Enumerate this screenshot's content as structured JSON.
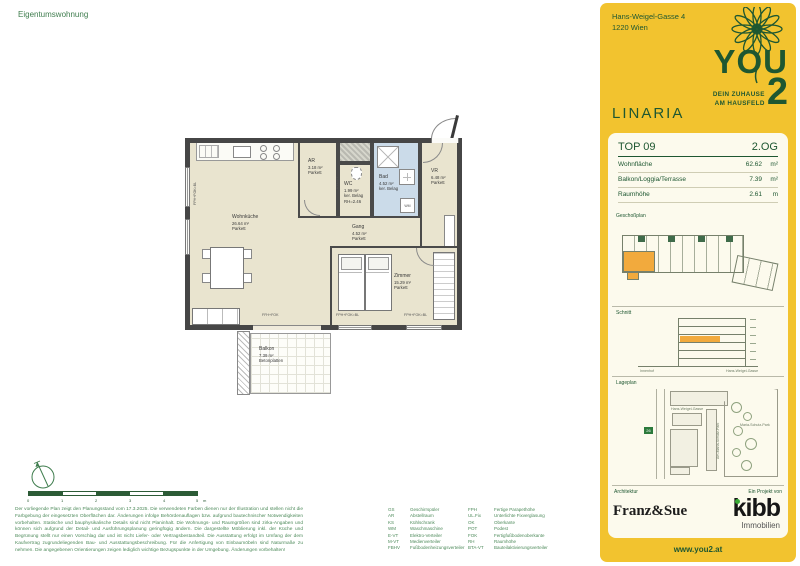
{
  "page": {
    "label": "Eigentumswohnung"
  },
  "colors": {
    "brand_yellow": "#F2C32F",
    "brand_green": "#1E5731",
    "highlight_orange": "#F2AA3D"
  },
  "sidebar": {
    "address": [
      "Hans-Weigel-Gasse 4",
      "1220 Wien"
    ],
    "logo": {
      "you": "YOU",
      "two": "2",
      "tagline1": "DEIN ZUHAUSE",
      "tagline2": "AM HAUSFELD"
    },
    "project": "LINARIA",
    "unit": {
      "top": "TOP 09",
      "floor": "2.OG"
    },
    "metrics": [
      {
        "label": "Wohnfläche",
        "value": "62.62",
        "unit": "m²"
      },
      {
        "label": "Balkon/Loggia/Terrasse",
        "value": "7.39",
        "unit": "m²"
      },
      {
        "label": "Raumhöhe",
        "value": "2.61",
        "unit": "m"
      }
    ],
    "sections": {
      "plan": "Geschoßplan",
      "section": "Schnitt",
      "site": "Lageplan",
      "architect": "Architektur",
      "project_by": "Ein Projekt von"
    },
    "schnitt": {
      "left_label": "Innenhof",
      "right_label": "Hans-Weigel-Gasse"
    },
    "site": {
      "street": "Hans-Weigel-Gasse",
      "street2": "Am-Maria-Schutz-Park",
      "park": "Maria-Schutz-Park",
      "transit": "26"
    },
    "brands": {
      "architect": "Franz&Sue",
      "developer": "kibb",
      "developer_sub": "Immobilien"
    },
    "website": "www.you2.at"
  },
  "plan": {
    "rooms": {
      "wohnkueche": {
        "name": "Wohnküche",
        "area": "26.64 m²",
        "floor": "Parkett"
      },
      "ar": {
        "name": "AR",
        "area": "3.18 m²",
        "floor": "Parkett"
      },
      "wc": {
        "name": "WC",
        "area": "1.99 m²",
        "floor": "ker. Belag",
        "note": "RH=2.46"
      },
      "bad": {
        "name": "Bad",
        "area": "4.52 m²",
        "floor": "ker. Belag"
      },
      "vr": {
        "name": "VR",
        "area": "6.48 m²",
        "floor": "Parkett"
      },
      "gang": {
        "name": "Gang",
        "area": "4.52 m²",
        "floor": "Parkett"
      },
      "zimmer": {
        "name": "Zimmer",
        "area": "15.29 m²",
        "floor": "Parkett"
      },
      "balkon": {
        "name": "Balkon",
        "area": "7.39 m²",
        "floor": "Betonplatten"
      }
    },
    "annotations": {
      "window": "FPH+FOK=BL",
      "door": "FFH+FOK",
      "shaft": "BTA/VT",
      "wm": "WM"
    },
    "scale": {
      "ticks": [
        "0",
        "1",
        "2",
        "3",
        "4",
        "5"
      ],
      "unit": "m"
    }
  },
  "legend": {
    "left": [
      {
        "abbr": "GS",
        "term": "Geschirrspüler"
      },
      {
        "abbr": "AR",
        "term": "Abstellraum"
      },
      {
        "abbr": "KS",
        "term": "Kühlschrank"
      },
      {
        "abbr": "WM",
        "term": "Waschmaschine"
      },
      {
        "abbr": "E-VT",
        "term": "Elektro-Verteiler"
      },
      {
        "abbr": "M-VT",
        "term": "Medienverteiler"
      },
      {
        "abbr": "FBHV",
        "term": "Fußbodenheizungsverteiler"
      }
    ],
    "right": [
      {
        "abbr": "FPH",
        "term": "Fertige Parapethöhe"
      },
      {
        "abbr": "UL.Fix",
        "term": "Unterlichte Fixverglasung"
      },
      {
        "abbr": "OK",
        "term": "Oberkante"
      },
      {
        "abbr": "POT",
        "term": "Podest"
      },
      {
        "abbr": "FOK",
        "term": "Fertigfußbodenoberkante"
      },
      {
        "abbr": "RH",
        "term": "Raumhöhe"
      },
      {
        "abbr": "BTA-VT",
        "term": "Bauteilaktivierungsverteiler"
      }
    ]
  },
  "disclaimer": "Der vorliegende Plan zeigt den Planungsstand vom 17.3.2025. Die verwendeten Farben dienen nur der Illustration und stellen nicht die Farbgebung der eingesetzten Oberflächen dar. Änderungen infolge Behördenauflagen bzw. aufgrund bautechnischer Notwendigkeiten vorbehalten. Statische und bauphysikalische Details sind nicht Planinhalt. Die Wohnungs- und Raumgrößen sind zirka-Angaben und können sich aufgrund der Detail- und Ausführungsplanung geringfügig ändern. Die dargestellte Möblierung inkl. der Küche und Begrünung stellt nur einen Vorschlag dar und ist nicht Liefer- oder Vertragsbestandteil. Die Ausstattung erfolgt im Umfang der dem Kaufvertrag zugrundeliegenden Bau- und Ausstattungsbeschreibung. Für die Anfertigung von Einbaumöbeln sind Naturmaße zu nehmen. Die angegebenen Orientierungen zeigen lediglich wichtige Bezugspunkte in der Umgebung. Änderungen vorbehalten!"
}
